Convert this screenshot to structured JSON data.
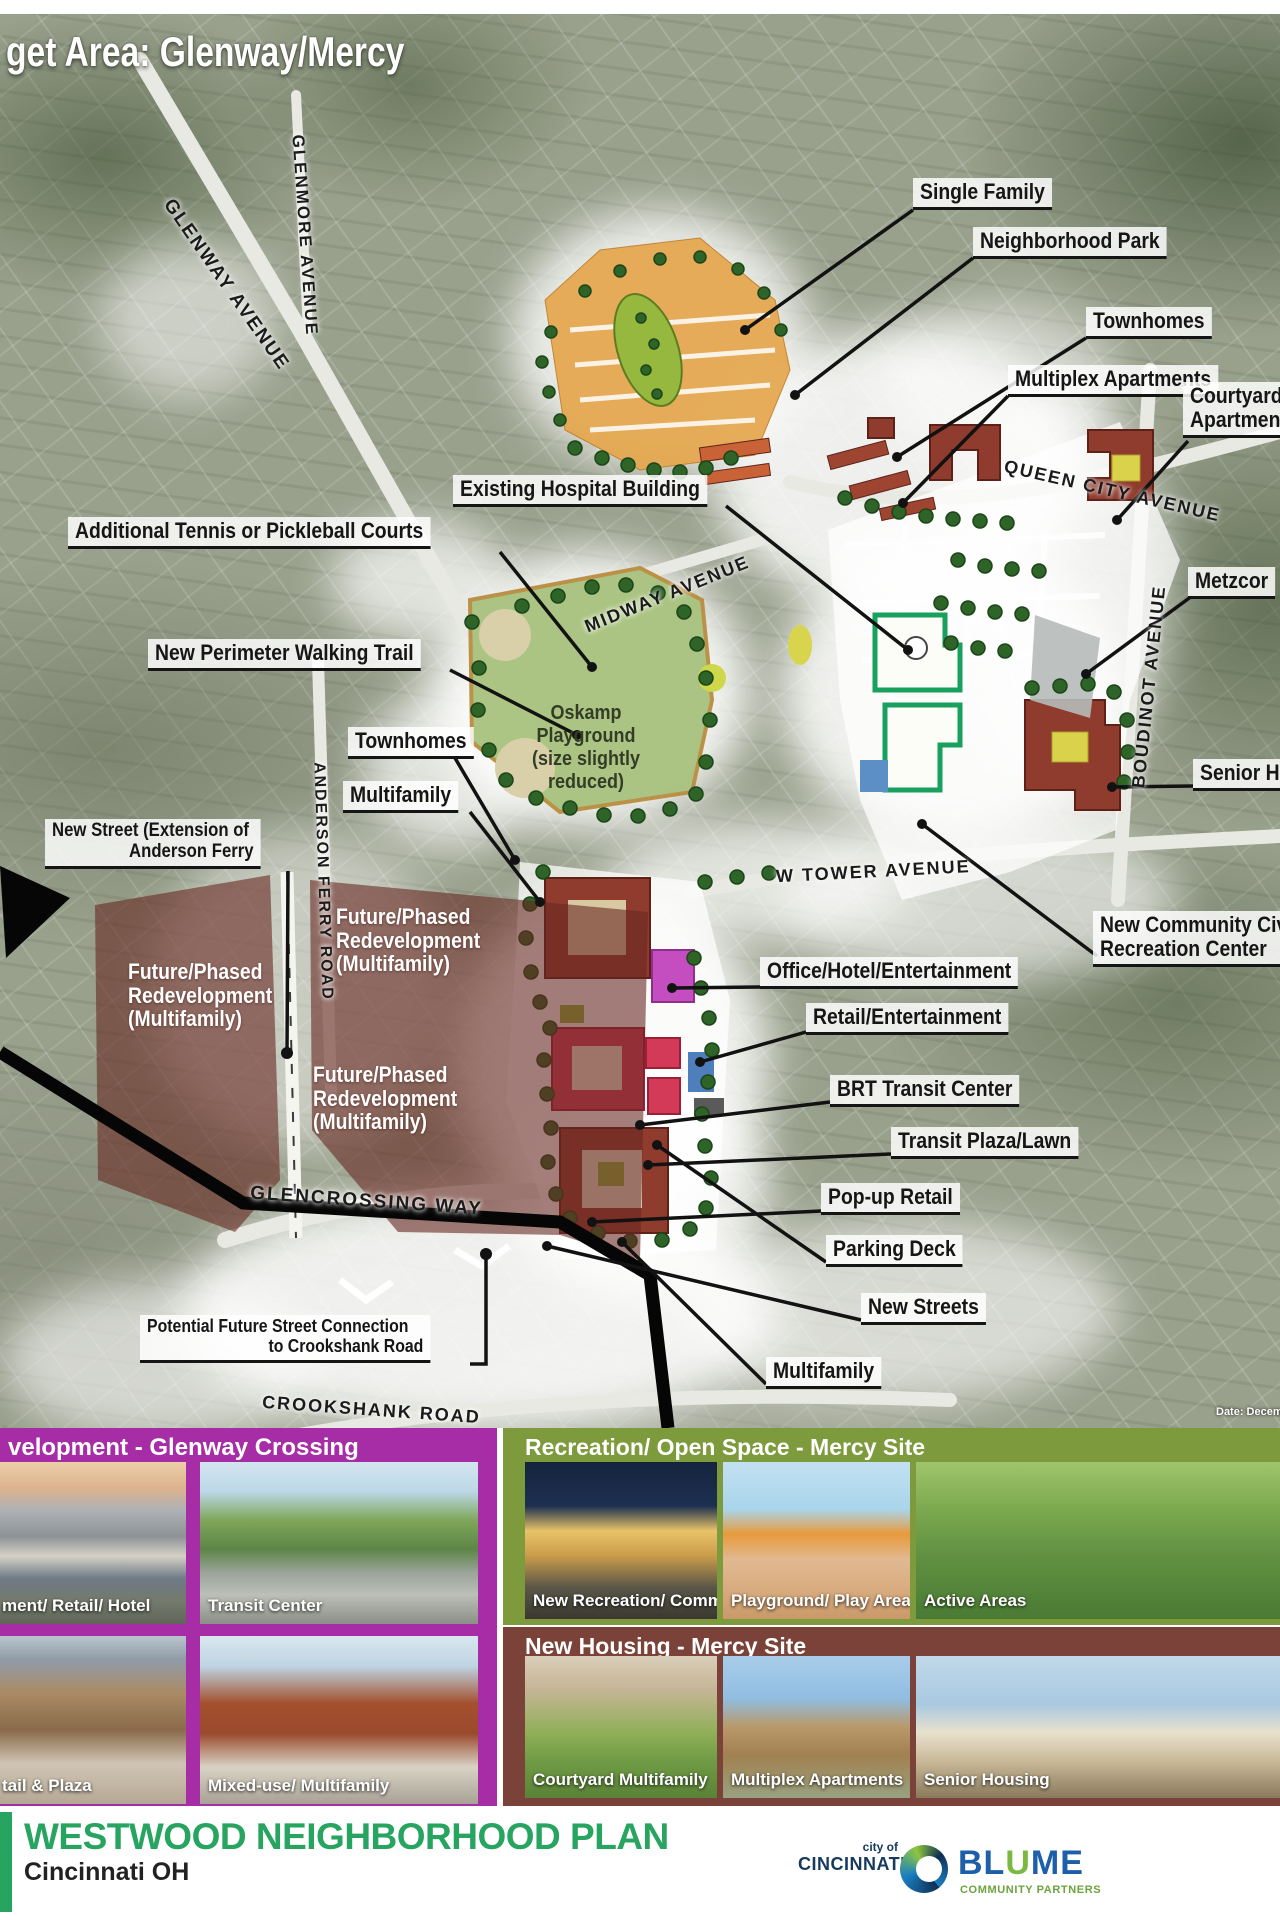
{
  "title": "get Area: Glenway/Mercy",
  "map": {
    "date_note": "Date: Decem",
    "streets": {
      "glenway": "GLENWAY AVENUE",
      "glenmore": "GLENMORE AVENUE",
      "queen_city": "QUEEN CITY AVENUE",
      "midway": "MIDWAY AVENUE",
      "boudinot": "BOUDINOT AVENUE",
      "anderson_ferry": "ANDERSON FERRY ROAD",
      "w_tower": "W TOWER AVENUE",
      "glencrossing": "GLENCROSSING WAY",
      "crookshank": "CROOKSHANK ROAD"
    },
    "callouts": [
      {
        "text": "Single Family"
      },
      {
        "text": "Neighborhood Park"
      },
      {
        "text": "Townhomes"
      },
      {
        "text": "Multiplex Apartments"
      },
      {
        "line1": "Courtyard Mult",
        "line2": "Apartments/ M"
      },
      {
        "text": "Existing Hospital Building"
      },
      {
        "text": "Additional Tennis or Pickleball Courts"
      },
      {
        "text": "New Perimeter Walking Trail"
      },
      {
        "text": "Townhomes"
      },
      {
        "text": "Multifamily"
      },
      {
        "line1": "New Street (Extension of",
        "line2": "Anderson Ferry"
      },
      {
        "text": "Office/Hotel/Entertainment"
      },
      {
        "text": "Retail/Entertainment"
      },
      {
        "text": "BRT Transit Center"
      },
      {
        "text": "Transit Plaza/Lawn"
      },
      {
        "text": "Pop-up Retail"
      },
      {
        "text": "Parking Deck"
      },
      {
        "text": "New Streets"
      },
      {
        "text": "Multifamily"
      },
      {
        "text": "Metzcor"
      },
      {
        "text": "Senior Hou"
      },
      {
        "line1": "New Community Civ",
        "line2": "Recreation Center"
      },
      {
        "line1": "Potential Future Street Connection",
        "line2": "to Crookshank Road"
      }
    ],
    "areas": {
      "oskamp_line1": "Oskamp Playground",
      "oskamp_line2": "(size slightly reduced)",
      "future_line1": "Future/Phased",
      "future_line2": "Redevelopment",
      "future_line3": "(Multifamily)"
    }
  },
  "panels": {
    "purple": {
      "header": "velopment - Glenway Crossing",
      "accent_color": "#A62DA5",
      "photos": [
        {
          "caption": "ment/ Retail/ Hotel"
        },
        {
          "caption": "Transit Center"
        },
        {
          "caption": "tail & Plaza"
        },
        {
          "caption": "Mixed-use/ Multifamily"
        }
      ]
    },
    "green": {
      "header": "Recreation/ Open Space - Mercy Site",
      "accent_color": "#7D9B3C",
      "photos": [
        {
          "caption": "New Recreation/ Community Center"
        },
        {
          "caption": "Playground/ Play Areas"
        },
        {
          "caption": "Active Areas"
        }
      ]
    },
    "brown": {
      "header": "New Housing - Mercy Site",
      "accent_color": "#7A4238",
      "photos": [
        {
          "caption": "Courtyard Multifamily"
        },
        {
          "caption": "Multiplex Apartments"
        },
        {
          "caption": "Senior Housing"
        }
      ]
    }
  },
  "footer": {
    "title": "WESTWOOD NEIGHBORHOOD PLAN",
    "subtitle": "Cincinnati OH",
    "title_color": "#27a45f",
    "cincinnati_top": "city of",
    "cincinnati": "CINCINNATI",
    "blume_bl": "BL",
    "blume_u": "U",
    "blume_me": "ME",
    "blume_sub": "COMMUNITY PARTNERS"
  }
}
